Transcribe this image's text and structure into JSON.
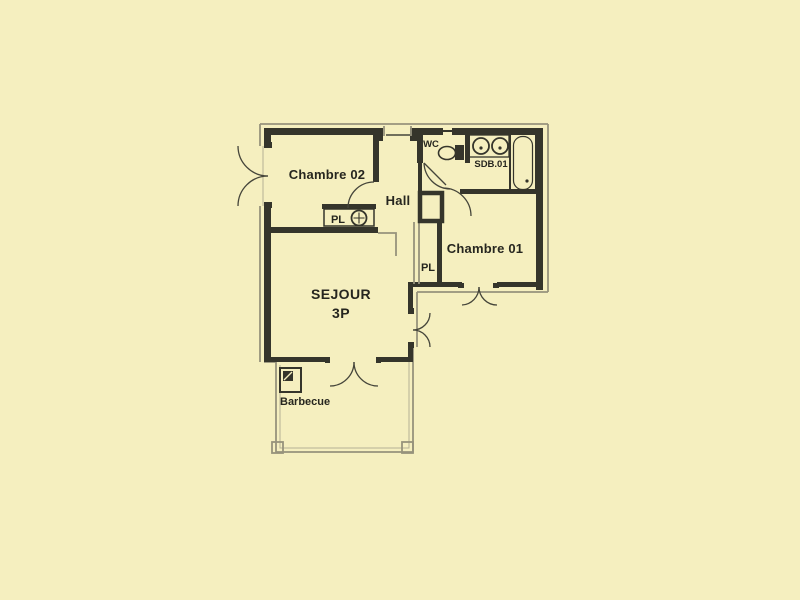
{
  "page": {
    "background_color": "#F5EFBF"
  },
  "plan": {
    "ink_color": "#35352B",
    "light_line_color": "#97937C",
    "text_color": "#26261F",
    "labels": {
      "chambre02": "Chambre 02",
      "chambre01": "Chambre 01",
      "hall": "Hall",
      "wc": "WC",
      "sdb": "SDB.01",
      "closet_chambre02": "PL",
      "closet_chambre01": "PL",
      "sejour_line1": "SEJOUR",
      "sejour_line2": "3P",
      "barbecue": "Barbecue"
    }
  }
}
